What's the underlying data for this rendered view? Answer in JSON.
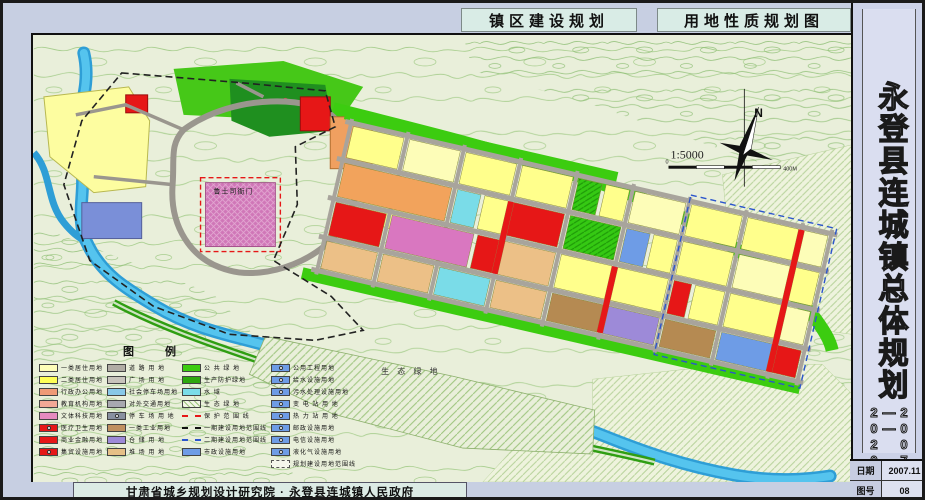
{
  "titles": {
    "left": "镇区建设规划",
    "right": "用地性质规划图"
  },
  "sidebar": {
    "title": "永登县连城镇总体规划",
    "years": "2007——2020",
    "date_label": "日期",
    "date_value": "2007.11",
    "fig_label": "图号",
    "fig_value": "08"
  },
  "footer": {
    "credit": "甘肃省城乡规划设计研究院 · 永登县连城镇人民政府"
  },
  "map_labels": {
    "north": "N",
    "scale": "1:5000",
    "scalebar_start": "0",
    "scalebar_end": "400M",
    "eco": "生 态 绿 地",
    "heritage": "鲁土司衙门"
  },
  "colors": {
    "paper": "#c7cfe2",
    "terrain": "#e9efda",
    "contour": "#a6cd8c",
    "river": "#3aaede",
    "road": "#a8a49c",
    "green": "#3ccc10",
    "residential1": "#fdfdb8",
    "residential2": "#ffff8c",
    "commercial": "#e61717",
    "education": "#d977c0",
    "industrial1": "#f2a35c",
    "industrial2": "#ecc087",
    "warehouse": "#9d8ad8",
    "storage": "#b58a52",
    "municipal": "#6e9ce6",
    "water": "#7adce8"
  },
  "legend": {
    "title": "图  例",
    "columns": [
      {
        "items": [
          {
            "label": "一类居住用地",
            "swatch": {
              "kind": "fill",
              "color": "#fdfdb8"
            }
          },
          {
            "label": "二类居住用地",
            "swatch": {
              "kind": "fill",
              "color": "#ffff56"
            }
          },
          {
            "label": "行政办公用地",
            "swatch": {
              "kind": "fill",
              "color": "#ef9a76"
            }
          },
          {
            "label": "教育机构用地",
            "swatch": {
              "kind": "fill",
              "color": "#f2a896"
            }
          },
          {
            "label": "文体科技用地",
            "swatch": {
              "kind": "fill",
              "color": "#e58ac0"
            }
          },
          {
            "label": "医疗卫生用地",
            "swatch": {
              "kind": "fill",
              "color": "#e61717",
              "icon": true
            }
          },
          {
            "label": "商业金融用地",
            "swatch": {
              "kind": "fill",
              "color": "#e61717"
            }
          },
          {
            "label": "集贸设施用地",
            "swatch": {
              "kind": "fill",
              "color": "#e61717",
              "icon": true
            }
          }
        ]
      },
      {
        "items": [
          {
            "label": "道 路 用 地",
            "swatch": {
              "kind": "fill",
              "color": "#b0aca4"
            }
          },
          {
            "label": "广 场 用 地",
            "swatch": {
              "kind": "fill",
              "color": "#c8c4bc"
            }
          },
          {
            "label": "社会停车场用地",
            "swatch": {
              "kind": "fill",
              "color": "#88c8e8"
            }
          },
          {
            "label": "对外交通用地",
            "swatch": {
              "kind": "fill",
              "color": "#a8a8b0"
            }
          },
          {
            "label": "停 车 场 用 地",
            "swatch": {
              "kind": "fill",
              "color": "#8890a0",
              "icon": true
            }
          },
          {
            "label": "一类工业用地",
            "swatch": {
              "kind": "fill",
              "color": "#c09060"
            }
          },
          {
            "label": "仓 储 用 地",
            "swatch": {
              "kind": "fill",
              "color": "#9d8ad8"
            }
          },
          {
            "label": "堆 场 用 地",
            "swatch": {
              "kind": "fill",
              "color": "#e6c087"
            }
          }
        ]
      },
      {
        "items": [
          {
            "label": "公 共 绿 地",
            "swatch": {
              "kind": "fill",
              "color": "#3ccc10"
            }
          },
          {
            "label": "生产防护绿地",
            "swatch": {
              "kind": "fill",
              "color": "#2da80e"
            }
          },
          {
            "label": "水       域",
            "swatch": {
              "kind": "fill",
              "color": "#7adce8"
            }
          },
          {
            "label": "生 态 绿 地",
            "swatch": {
              "kind": "hatch",
              "color": "#9cc47c"
            }
          },
          {
            "label": "保 护 范 围 线",
            "swatch": {
              "kind": "line",
              "color": "#e61717"
            }
          },
          {
            "label": "一期建设用地范围线",
            "swatch": {
              "kind": "line",
              "color": "#111111"
            }
          },
          {
            "label": "二期建设用地范围线",
            "swatch": {
              "kind": "line",
              "color": "#2b55cc"
            }
          },
          {
            "label": "市政设施用地",
            "swatch": {
              "kind": "fill",
              "color": "#6e9ce6"
            }
          }
        ]
      },
      {
        "items": [
          {
            "label": "公用工程用地",
            "swatch": {
              "kind": "fill",
              "color": "#6e9ce6",
              "icon": true
            }
          },
          {
            "label": "给水设施用地",
            "swatch": {
              "kind": "fill",
              "color": "#6e9ce6",
              "icon": true
            }
          },
          {
            "label": "污水处理设施用地",
            "swatch": {
              "kind": "fill",
              "color": "#6e9ce6",
              "icon": true
            }
          },
          {
            "label": "变 电 站 用 地",
            "swatch": {
              "kind": "fill",
              "color": "#6e9ce6",
              "icon": true
            }
          },
          {
            "label": "热 力 站 用 地",
            "swatch": {
              "kind": "fill",
              "color": "#6e9ce6",
              "icon": true
            }
          },
          {
            "label": "邮政设施用地",
            "swatch": {
              "kind": "fill",
              "color": "#6e9ce6",
              "icon": true
            }
          },
          {
            "label": "电信设施用地",
            "swatch": {
              "kind": "fill",
              "color": "#6e9ce6",
              "icon": true
            }
          },
          {
            "label": "液化气设施用地",
            "swatch": {
              "kind": "fill",
              "color": "#6e9ce6",
              "icon": true
            }
          },
          {
            "label": "规划建设用地范围线",
            "swatch": {
              "kind": "dashbox",
              "color": "#555555"
            }
          }
        ]
      }
    ]
  }
}
